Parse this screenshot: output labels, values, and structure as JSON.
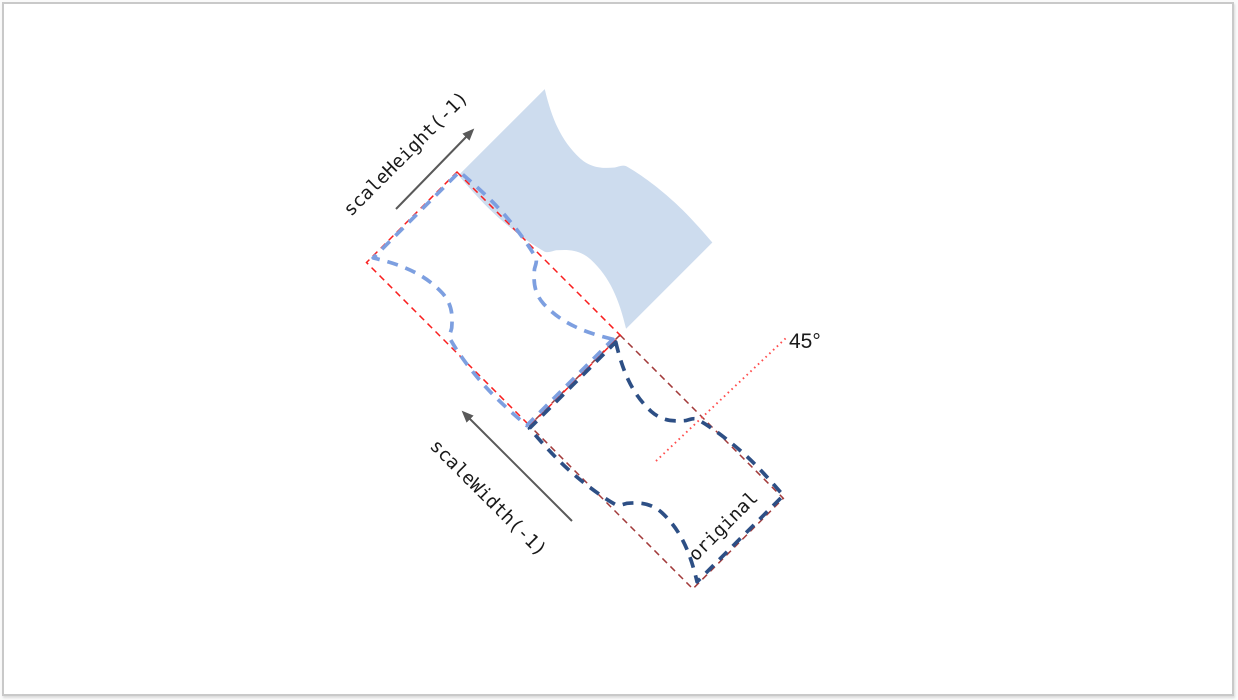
{
  "page": {
    "background": "#ffffff",
    "frame_border": "#c9c9c9"
  },
  "diagram": {
    "type": "flip-transform-illustration",
    "rotation_deg": 45,
    "labels": {
      "scale_height": "scaleHeight(-1)",
      "scale_width": "scaleWidth(-1)",
      "original": "original",
      "angle": "45°"
    },
    "colors": {
      "solid_fill": "#cddcee",
      "flipped_stroke": "#7d9fe0",
      "original_stroke": "#2d4f85",
      "bbox_flipped": "#f91e1e",
      "bbox_original": "#a23a3a",
      "angle_line": "#ff4d4d",
      "arrow": "#595959",
      "text": "#1a1a1a"
    }
  }
}
